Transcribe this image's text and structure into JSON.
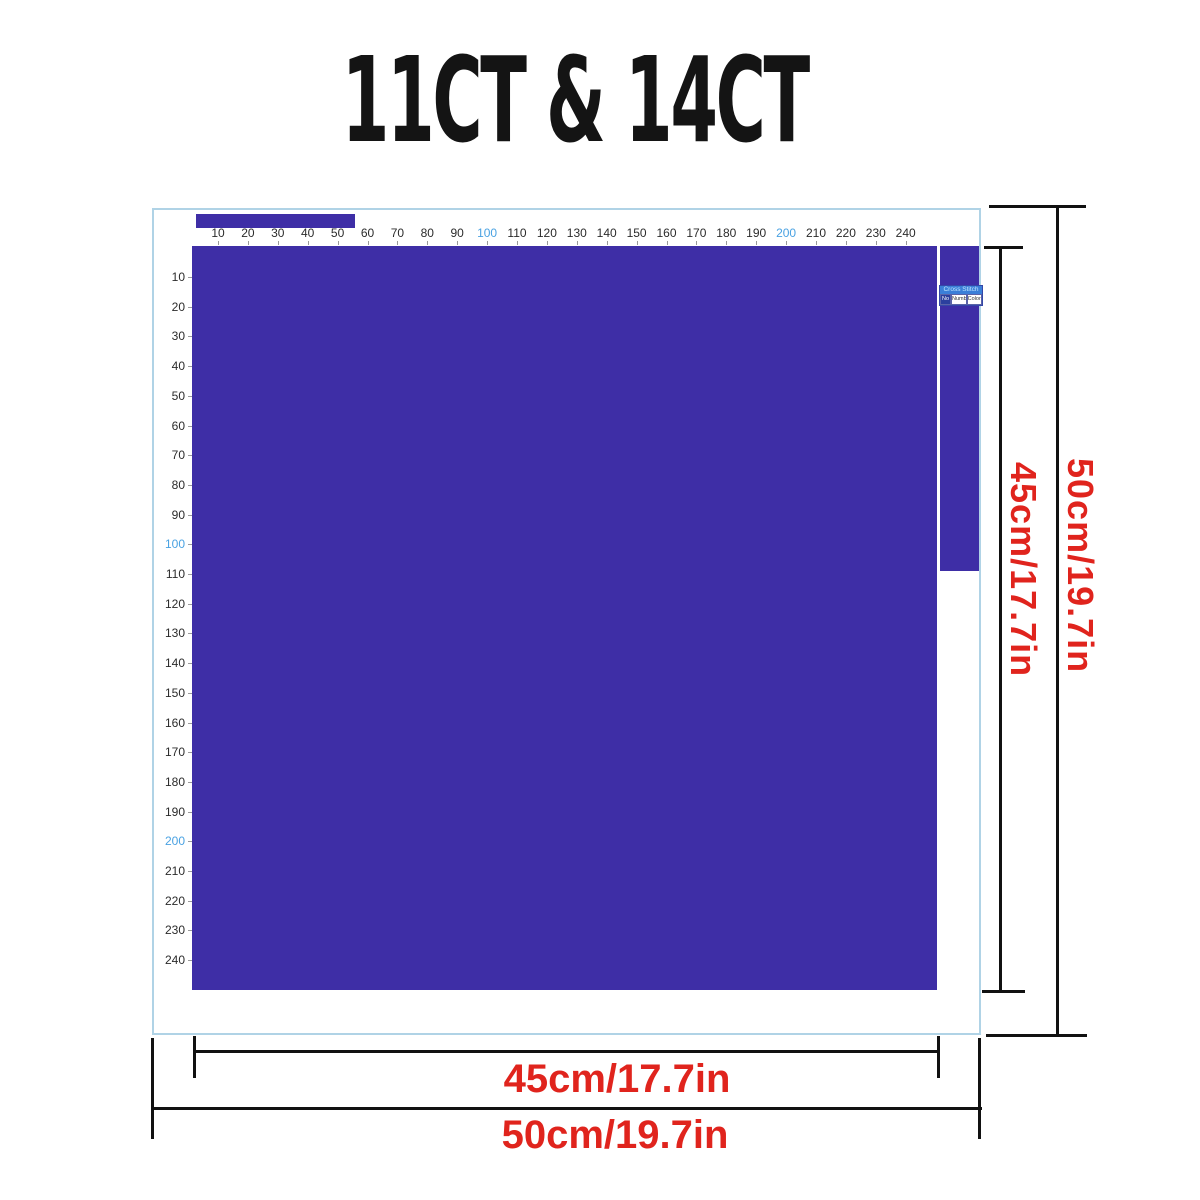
{
  "title": "11CT & 14CT",
  "rulers": {
    "top": {
      "values": [
        10,
        20,
        30,
        40,
        50,
        60,
        70,
        80,
        90,
        100,
        110,
        120,
        130,
        140,
        150,
        160,
        170,
        180,
        190,
        200,
        210,
        220,
        230,
        240
      ],
      "highlight": [
        100,
        200
      ]
    },
    "left": {
      "values": [
        10,
        20,
        30,
        40,
        50,
        60,
        70,
        80,
        90,
        100,
        110,
        120,
        130,
        140,
        150,
        160,
        170,
        180,
        190,
        200,
        210,
        220,
        230,
        240
      ],
      "highlight": [
        100,
        200
      ]
    }
  },
  "legend": {
    "header": "Cross Stitch",
    "columns": [
      "No",
      "Number",
      "Color"
    ]
  },
  "dimensions": {
    "inner_width_label": "45cm/17.7in",
    "outer_width_label": "50cm/19.7in",
    "inner_height_label": "45cm/17.7in",
    "outer_height_label": "50cm/19.7in"
  },
  "colors": {
    "fabric_purple": "#3e2ea6",
    "dimension_text_red": "#e0241d",
    "ruler_highlight_blue": "#4aa2e2",
    "ruler_number": "#2b2b2b",
    "chart_border_blue": "#b0d3e6",
    "dimension_line_black": "#111111"
  }
}
